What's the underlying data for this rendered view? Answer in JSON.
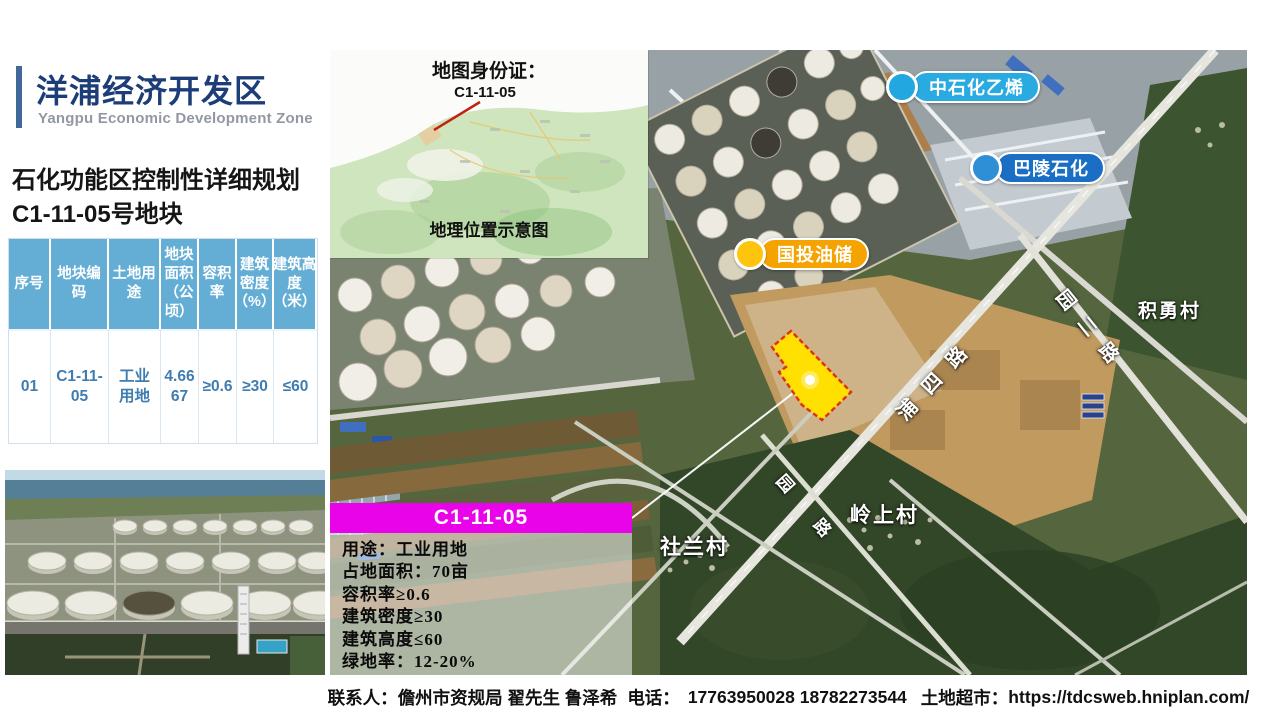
{
  "header": {
    "title_cn": "洋浦经济开发区",
    "title_en": "Yangpu Economic Development Zone",
    "plan_line1": "石化功能区控制性详细规划",
    "plan_line2": "C1-11-05号地块"
  },
  "table": {
    "headers": [
      "序号",
      "地块编码",
      "土地用途",
      "地块面积（公顷）",
      "容积率",
      "建筑密度（%）",
      "建筑高度（米）"
    ],
    "row": [
      "01",
      "C1-11-05",
      "工业用地",
      "4.6667",
      "≥0.6",
      "≥30",
      "≤60"
    ]
  },
  "inset": {
    "title": "地图身份证：",
    "parcel_id": "C1-11-05",
    "caption": "地理位置示意图"
  },
  "map": {
    "pill_ethylene": "中石化乙烯",
    "pill_baling": "巴陵石化",
    "pill_guotou": "国投油储",
    "road_puxi": "浦四路",
    "road_yuaner": "园二路",
    "glyph_yuan": "园",
    "glyph_lu": "路",
    "village_jiyong": "积勇村",
    "village_shelan": "社兰村",
    "village_lingshang": "岭上村",
    "banner": "C1-11-05",
    "info": [
      "用途：工业用地",
      "占地面积：70亩",
      "容积率≥0.6",
      "建筑密度≥30",
      "建筑高度≤60",
      "绿地率：12-20%"
    ]
  },
  "footer": {
    "contact_label": "联系人：",
    "contacts": "儋州市资规局  翟先生  鲁泽希",
    "phone_label": "电话：",
    "phones": "17763950028  18782273544",
    "market_label": "土地超市：",
    "url": "https://tdcsweb.hniplan.com/"
  },
  "colors": {
    "accent_navy": "#1d3d78",
    "accent_bar": "#41679b",
    "table_header_blue": "#64aed5",
    "table_text_blue": "#3f7cb0",
    "banner_magenta": "#e903e9",
    "pill_cyan": "#29abe2",
    "pill_blue": "#1a6fc4",
    "pill_amber": "#f5a300",
    "parcel_fill_yellow": "#ffe000",
    "parcel_border_red": "#e03010"
  }
}
